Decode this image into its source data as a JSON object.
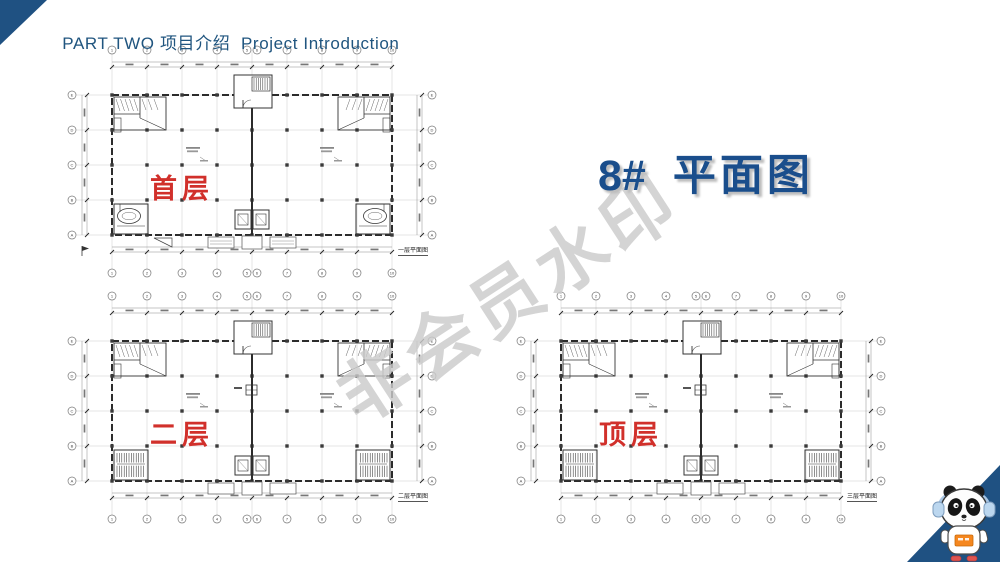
{
  "slide": {
    "header": "PART TWO 项目介绍  Project Introduction",
    "title": {
      "number": "8#",
      "text": "平面图"
    }
  },
  "watermark": "非会员水印",
  "plans": [
    {
      "label": "首层",
      "caption": "一层平面图"
    },
    {
      "label": "二层",
      "caption": "二层平面图"
    },
    {
      "label": "顶层",
      "caption": "三层平面图"
    }
  ],
  "grid": {
    "top_labels": [
      "1",
      "2",
      "3",
      "4",
      "5",
      "6",
      "7",
      "8",
      "9",
      "10"
    ],
    "side_labels": [
      "E",
      "D",
      "C",
      "B",
      "A"
    ]
  },
  "colors": {
    "accent_blue": "#1f5182",
    "title_blue": "#1a4e8c",
    "label_red": "#d1302b",
    "watermark_gray": "#cbcbcb"
  }
}
